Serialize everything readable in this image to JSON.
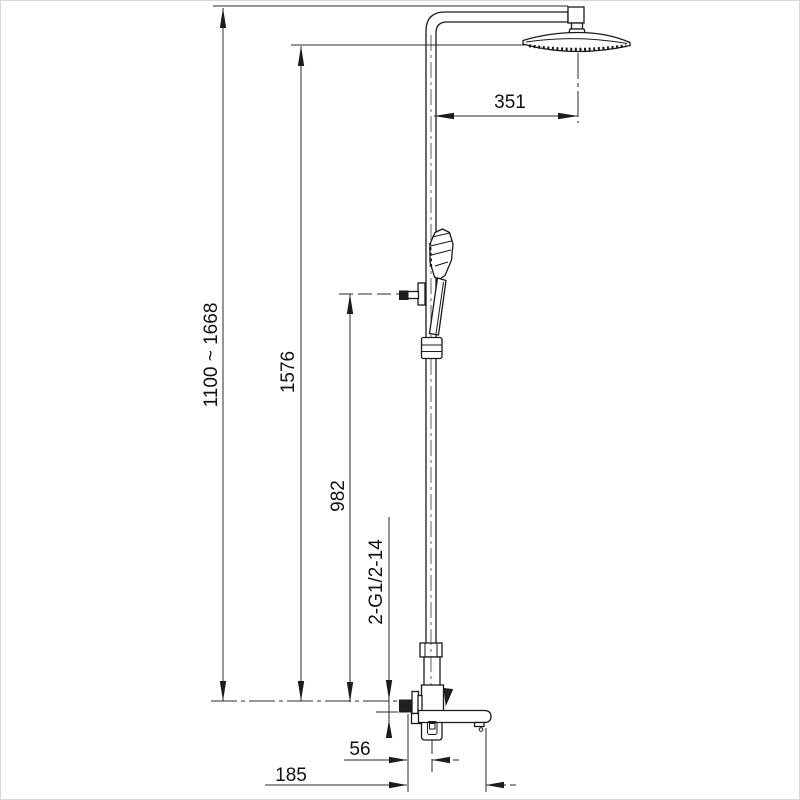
{
  "drawing": {
    "type": "technical-dimension-drawing",
    "subject": "thermostatic shower column with overhead rain shower, hand shower and tub spout",
    "line_color": "#1a1a1a",
    "background_color": "#ffffff",
    "dimensions": {
      "height_range": "1100 ~ 1668",
      "overall_height": "1576",
      "hand_shower_height": "982",
      "thread_spec": "2-G1/2-14",
      "arm_reach": "351",
      "spout_offset": "56",
      "spout_reach": "185"
    }
  }
}
